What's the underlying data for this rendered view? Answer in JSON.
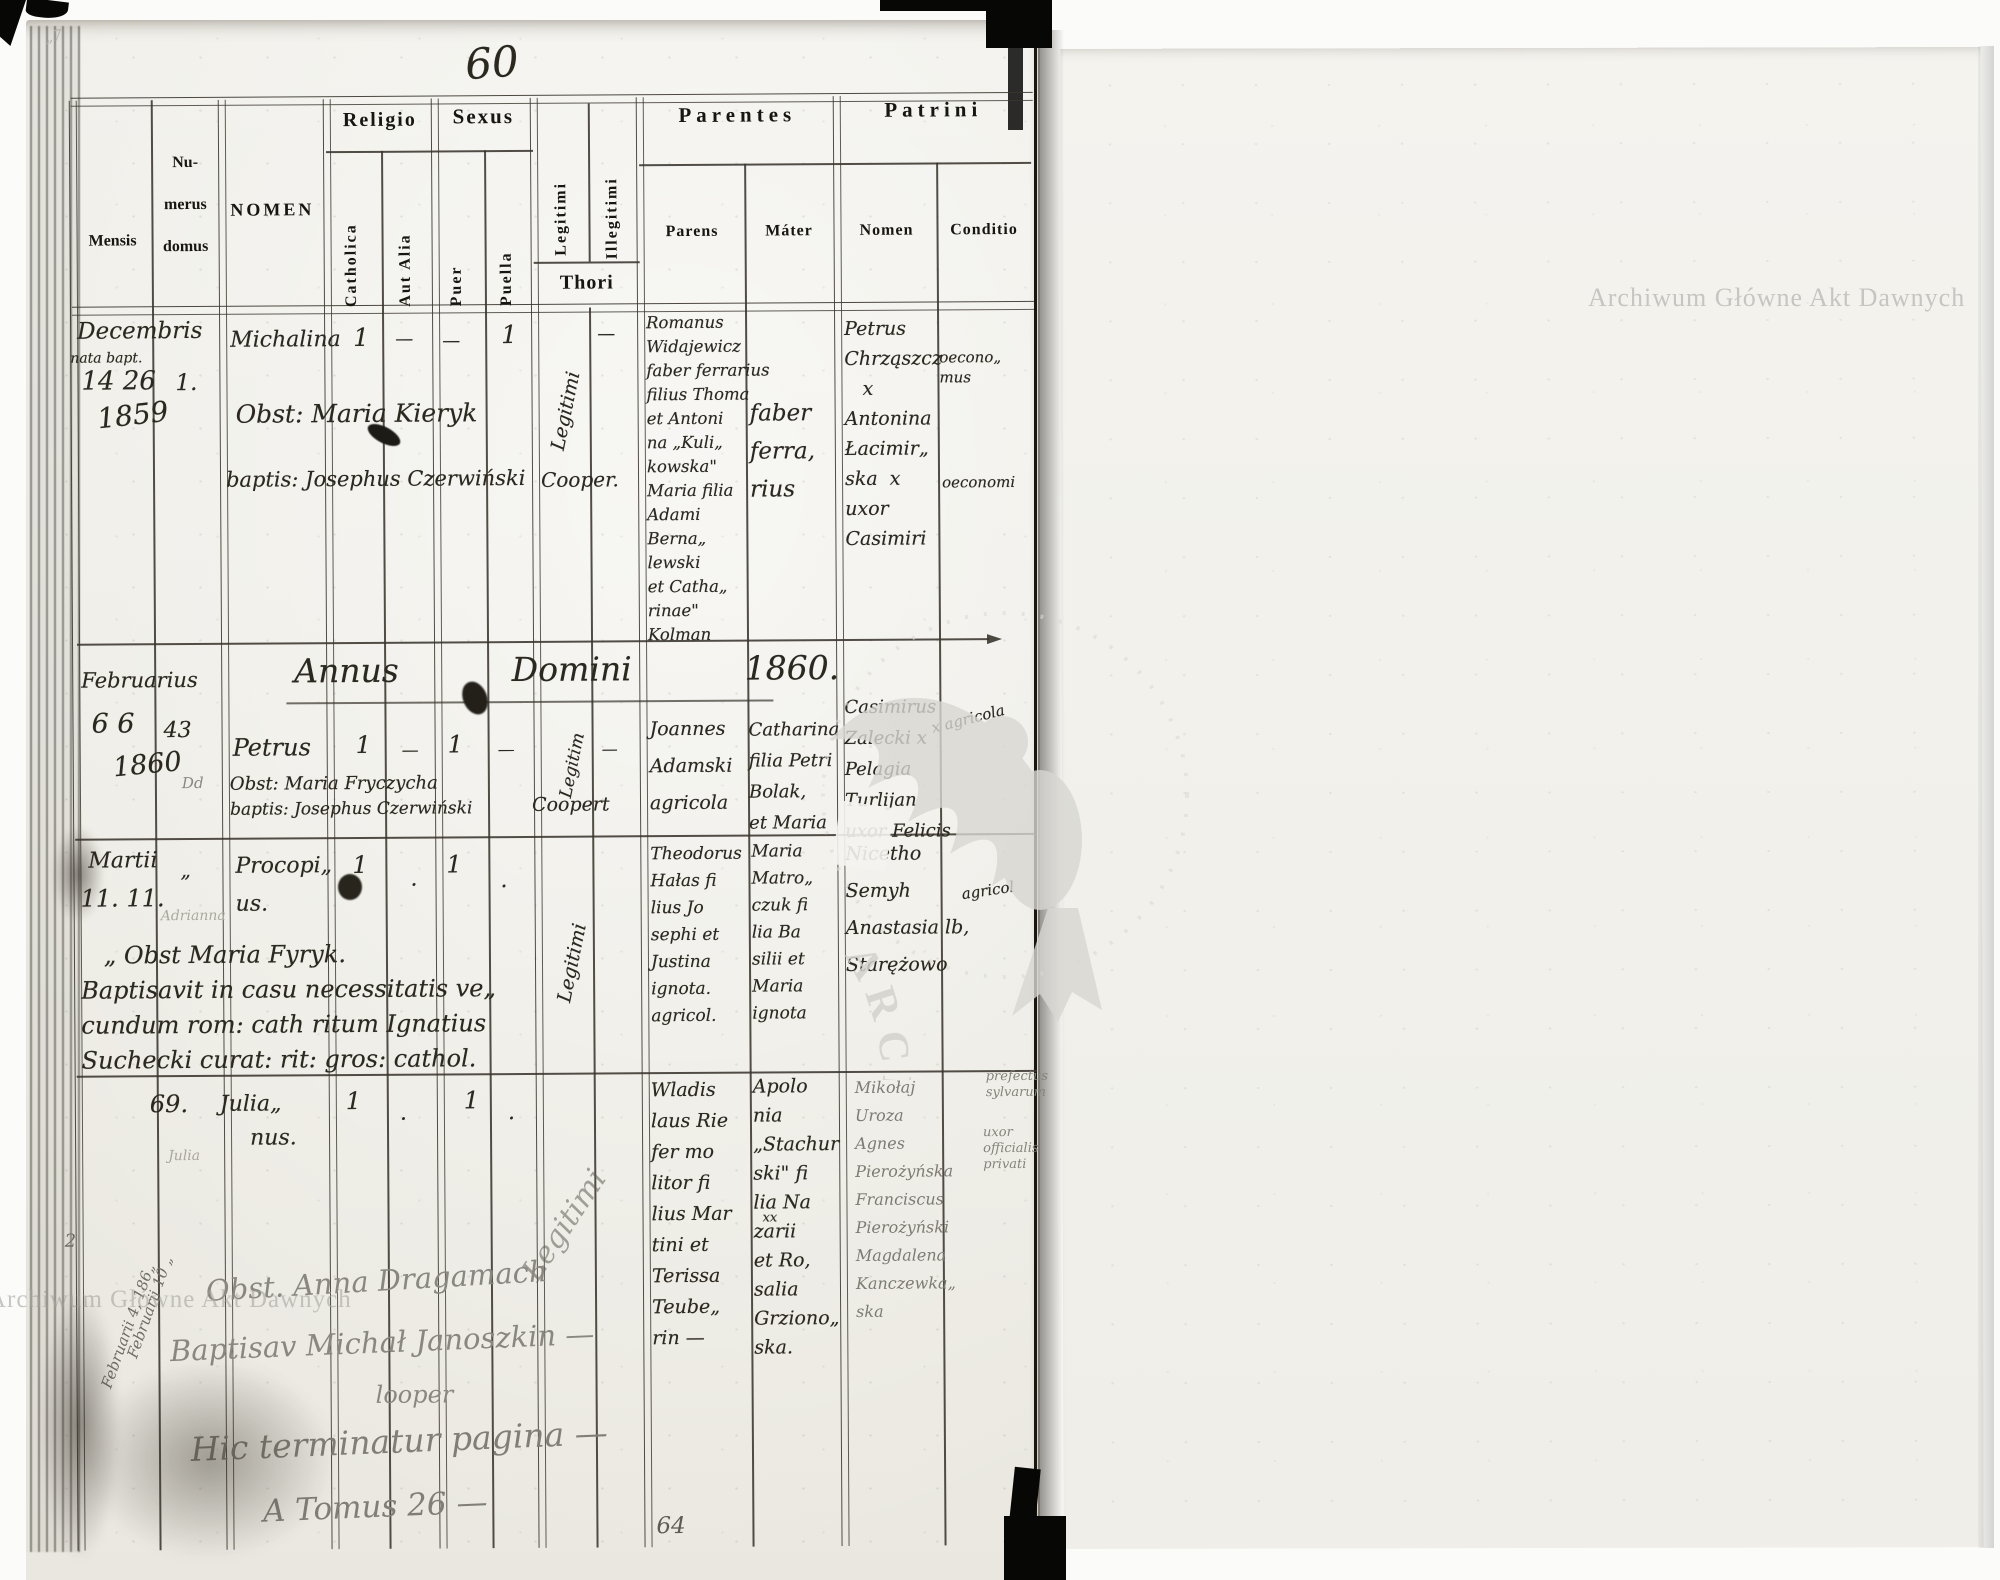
{
  "archive": {
    "watermark_text": "Archiwum Główne Akt Dawnych",
    "stamp_text": "ARCHIWUM GŁÓWNE • AKT DAWNYCH •"
  },
  "page": {
    "number_top": "60",
    "number_bottom": "64",
    "corner_mark": "„7"
  },
  "table": {
    "headers": {
      "mensis": "Mensis",
      "numerus_domus": "Nu-\nmerus\ndomus",
      "nomen": "NOMEN",
      "religio": "Religio",
      "catholica": "Catholica",
      "aut_alia": "Aut Alia",
      "sexus": "Sexus",
      "puer": "Puer",
      "puella": "Puella",
      "legitimi": "Legitimi",
      "illegitimi": "Illegitimi",
      "thori": "Thori",
      "parentes": "Parentes",
      "parens": "Parens",
      "mater": "Máter",
      "patrini": "Patrini",
      "patrini_nomen": "Nomen",
      "conditio": "Conditio"
    }
  },
  "annus_heading": "Annus  Domini  1860.",
  "entries": [
    {
      "month": "Decembris",
      "month_note": "nata bapt.",
      "days": "14 26",
      "year": "1859",
      "house": "1.",
      "name": "Michalina",
      "midwife": "Obst: Maria Kieryk",
      "baptizer": "baptis: Josephus Czerwiński",
      "baptizer_title": "Cooper.",
      "catholica": "1",
      "aut_alia": "—",
      "puer": "—",
      "puella": "1",
      "thori": "Legitimi",
      "illegitimi": "—",
      "parens": "Romanus\nWidajewicz\nfaber ferrarius\nfilius Thoma\net Antoni\nna „Kuli„\nkowska\"\nMaria filia\nAdami\nBerna„\nlewski\net Catha„\nrinae\"\nKolman",
      "mater": "faber\nferra,\nrius",
      "patrini": "Petrus\nChrząszcz\n   x\nAntonina\nŁacimir„\nska  x\nuxor\nCasimiri",
      "conditio_a": "oecono„\nmus",
      "conditio_b": "oeconomi"
    },
    {
      "month": "Februarius",
      "days": "6 6",
      "year": "1860",
      "house": "43",
      "house_note": "Dd",
      "name": "Petrus",
      "midwife": "Obst: Maria Fryczycha",
      "baptizer": "baptis: Josephus Czerwiński",
      "baptizer_title": "Coopert",
      "catholica": "1",
      "aut_alia": "—",
      "puer": "1",
      "puella": "—",
      "thori": "Legitim",
      "illegitimi": "—",
      "parens": "Joannes\nAdamski\nagricola",
      "mater": "Catharina\nfilia Petri\nBolak,\net Maria",
      "patrini": "Casimirus\nZalecki x\nPelagia\nTurlijan\nuxor Felicis",
      "conditio_a": "x agricola"
    },
    {
      "month": "Martii",
      "ditto": "„",
      "days": "11. 11.",
      "pencil_note": "Adrianna",
      "name": "Procopi„\nus.",
      "catholica": "1",
      "aut_alia": ".",
      "puer": "1",
      "puella": ".",
      "thori": "Legitimi",
      "parens": "Theodorus\nHałas fi\nlius Jo\nsephi et\nJustina\nignota.\nagricol.",
      "mater": "Maria\nMatro„\nczuk fi\nlia Ba\nsilii et\nMaria\nignota",
      "patrini": "Nicetho\nSemyh\nAnastasia lb,\nStarężowo",
      "conditio_a": "agricol",
      "marginal_note": "   „ Obst Maria Fyryk.\nBaptisavit in casu necessitatis ve„\ncundum rom: cath ritum Ignatius\nSuchecki curat: rit: gros: cathol."
    },
    {
      "house": "69.",
      "name": "Julia„",
      "name2": "nus.",
      "pencil_note": "Julia",
      "margin_a": "Februarii 10 „",
      "margin_b": "Februarii 4, 186„",
      "margin_num": "2",
      "catholica": "1",
      "aut_alia": ".",
      "puer": "1",
      "puella": ".",
      "thori": "Legitimi",
      "parens": "Wladis\nlaus Rie\nfer mo\nlitor fi\nlius Mar\ntini et\nTerissa\nTeube„\nrin —",
      "mater": "Apolo\nnia\n„Stachur\nski\" fi\nlia Na\nzarii\net Ro,\nsalia\nGrziono„\nska.",
      "mater_mark": "xx",
      "patrini": "Mikołaj\nUroza\nAgnes\nPierożyńska\nFranciscus\nPierożyński\nMagdalena\nKanczewka„\nska",
      "conditio_a": "prefectus\nsylvarum",
      "conditio_b": "uxor\nofficialis\nprivati"
    }
  ],
  "footer": {
    "line1": "Obst. Anna Dragamach",
    "line2": "Baptisav Michał Janoszkin —",
    "line3": "looper",
    "line4": "Hic terminatur pagina —",
    "line5": "A Tomus 26 —"
  }
}
